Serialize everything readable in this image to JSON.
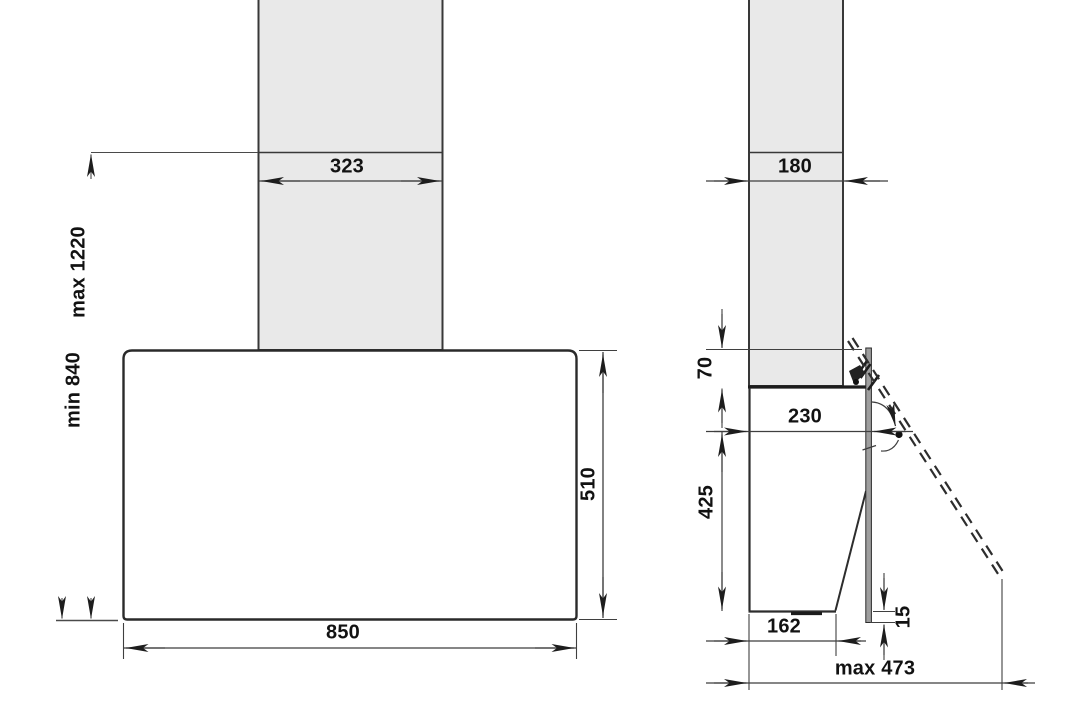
{
  "drawing": {
    "type": "technical-dimension-drawing",
    "colors": {
      "outline": "#2d2d2d",
      "dim_line": "#454545",
      "chimney_fill": "#e9e9e9",
      "body_fill": "#ffffff",
      "glass_fill": "#9e9e9e",
      "label_text": "#121212",
      "background": "#ffffff"
    },
    "front_view": {
      "dims": {
        "chimney_width": "323",
        "height_max": "max 1220",
        "height_min": "min 840",
        "body_width": "850",
        "body_height": "510"
      }
    },
    "side_view": {
      "dims": {
        "chimney_depth": "180",
        "glass_top_offset": "70",
        "depth_closed": "230",
        "rear_height": "425",
        "bottom_depth": "162",
        "glass_bottom_offset": "15",
        "depth_open_max": "max 473"
      }
    }
  }
}
